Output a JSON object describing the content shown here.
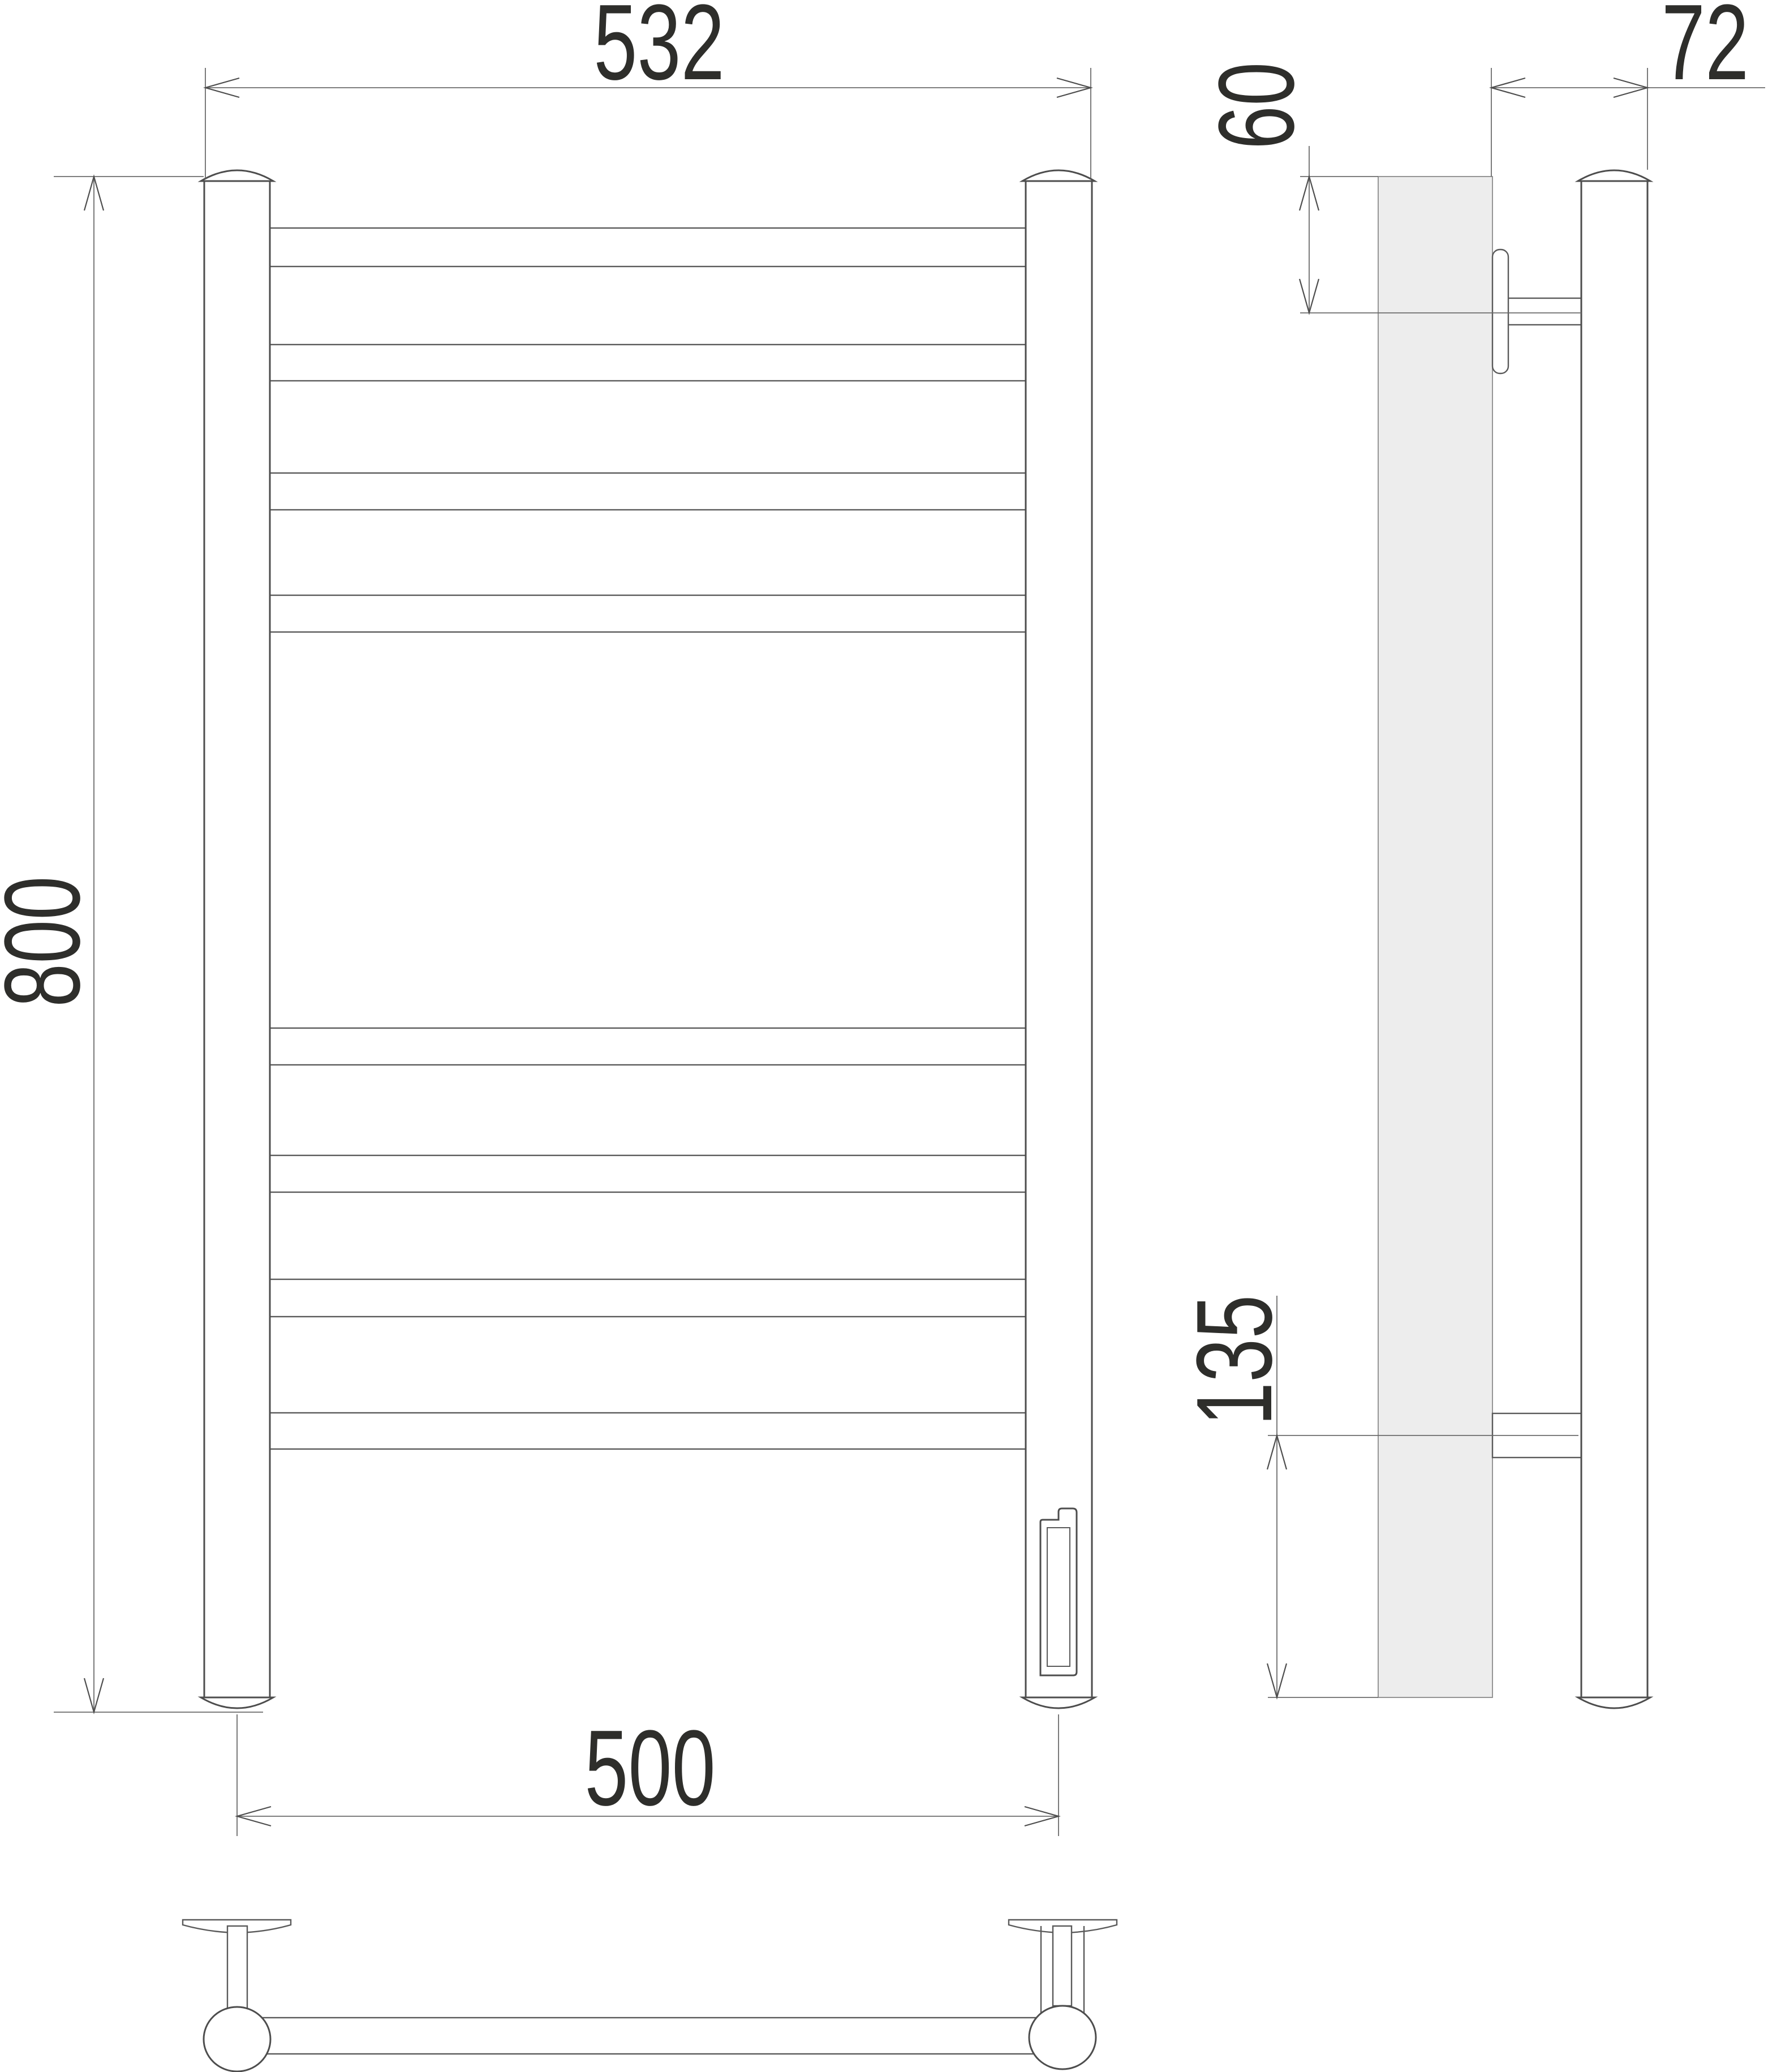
{
  "drawing": {
    "type": "technical-dimension-drawing",
    "subject": "ladder towel rail (electric, wall mounted)",
    "views": [
      "front",
      "side",
      "bottom"
    ],
    "rung_count": 8,
    "dimensions": {
      "overall_width": {
        "value": "532",
        "orientation": "horizontal",
        "location": "top of front view"
      },
      "overall_height": {
        "value": "800",
        "orientation": "vertical",
        "location": "left of front view"
      },
      "mounting_width": {
        "value": "500",
        "orientation": "horizontal",
        "location": "bottom of front view, post centers"
      },
      "depth": {
        "value": "72",
        "orientation": "horizontal",
        "location": "top of side view, wall face to post"
      },
      "top_bracket_offset": {
        "value": "60",
        "orientation": "vertical",
        "location": "side view, top edge to upper bracket axis"
      },
      "bottom_bracket_offset": {
        "value": "135",
        "orientation": "vertical",
        "location": "side view, lower bracket axis to bottom"
      }
    },
    "colors": {
      "background": "#ffffff",
      "object_line": "#4d4d4d",
      "dimension_line": "#6b6b6b",
      "text": "#2e2e2b",
      "wall_fill": "#ededed"
    }
  }
}
